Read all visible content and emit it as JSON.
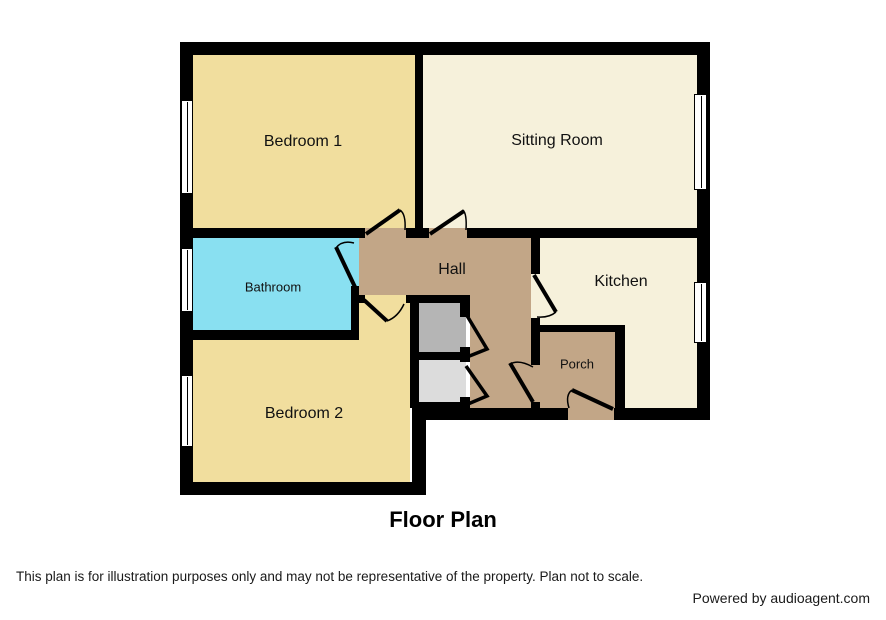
{
  "footer": {
    "title": "Floor Plan",
    "disclaimer": "This plan is for illustration purposes only and may not be representative of the property. Plan not to scale.",
    "credit": "Powered by audioagent.com"
  },
  "rooms": {
    "bedroom1": {
      "label": "Bedroom 1"
    },
    "sitting": {
      "label": "Sitting Room"
    },
    "bathroom": {
      "label": "Bathroom"
    },
    "hall": {
      "label": "Hall"
    },
    "kitchen": {
      "label": "Kitchen"
    },
    "bedroom2": {
      "label": "Bedroom 2"
    },
    "porch": {
      "label": "Porch"
    }
  },
  "colors": {
    "wall": "#000000",
    "bedroom": "#F1DE9E",
    "living": "#F6F1DB",
    "bathroom": "#89E0F1",
    "hall": "#C2A687",
    "closet_dark": "#B5B5B5",
    "closet_light": "#DCDCDC",
    "window": "#FFFFFF",
    "background": "#FFFFFF"
  },
  "symbols": {
    "windows": [
      "bedroom1-window",
      "bathroom-window",
      "bedroom2-window",
      "sitting-room-window",
      "kitchen-window"
    ],
    "doors": [
      "bedroom1-door",
      "sitting-room-door",
      "bathroom-door",
      "bedroom2-door",
      "kitchen-door",
      "porch-door",
      "front-door",
      "closet-doors"
    ]
  }
}
